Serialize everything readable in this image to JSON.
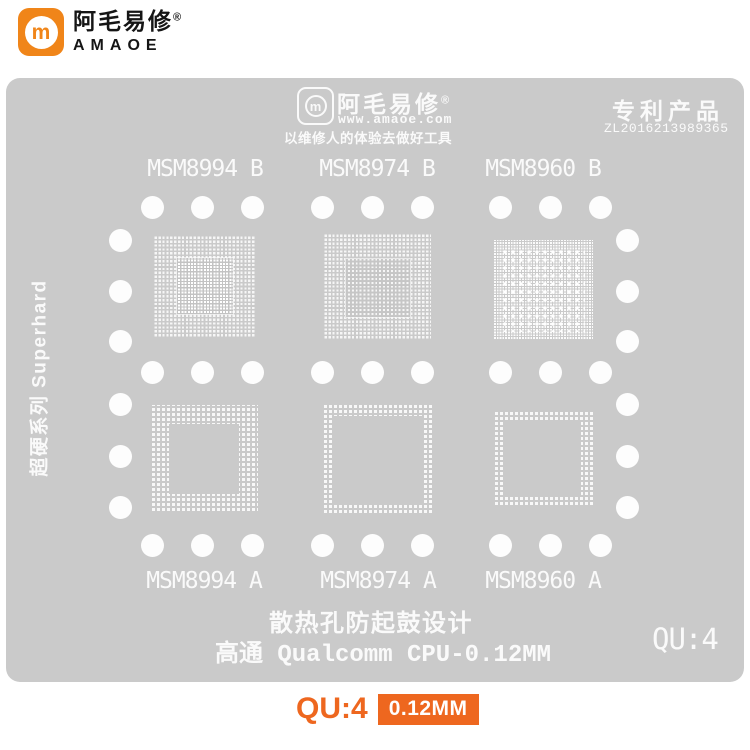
{
  "header": {
    "brand": {
      "name_cn": "阿毛易修",
      "reg_mark": "®",
      "name_en": "AMAOE",
      "monogram": "m"
    }
  },
  "stencil": {
    "logo": {
      "name_cn": "阿毛易修",
      "reg_mark": "®",
      "website": "www.amaoe.com",
      "slogan": "以维修人的体验去做好工具",
      "monogram": "m"
    },
    "patent": {
      "title": "专利产品",
      "number": "ZL2016213989365"
    },
    "side_label": "超硬系列 Superhard",
    "top_row_labels": [
      "MSM8994 B",
      "MSM8974 B",
      "MSM8960 B"
    ],
    "bottom_row_labels": [
      "MSM8994 A",
      "MSM8974 A",
      "MSM8960 A"
    ],
    "footer": {
      "design_note": "散热孔防起鼓设计",
      "product_line": "高通 Qualcomm CPU-0.12MM",
      "model_code": "QU:4"
    }
  },
  "caption": {
    "model_code": "QU:4",
    "thickness_badge": "0.12MM"
  },
  "colors": {
    "plate_gray": "#cacaca",
    "stencil_white": "#fafafa",
    "logo_orange": "#f08519",
    "accent_orange": "#ee671f"
  }
}
